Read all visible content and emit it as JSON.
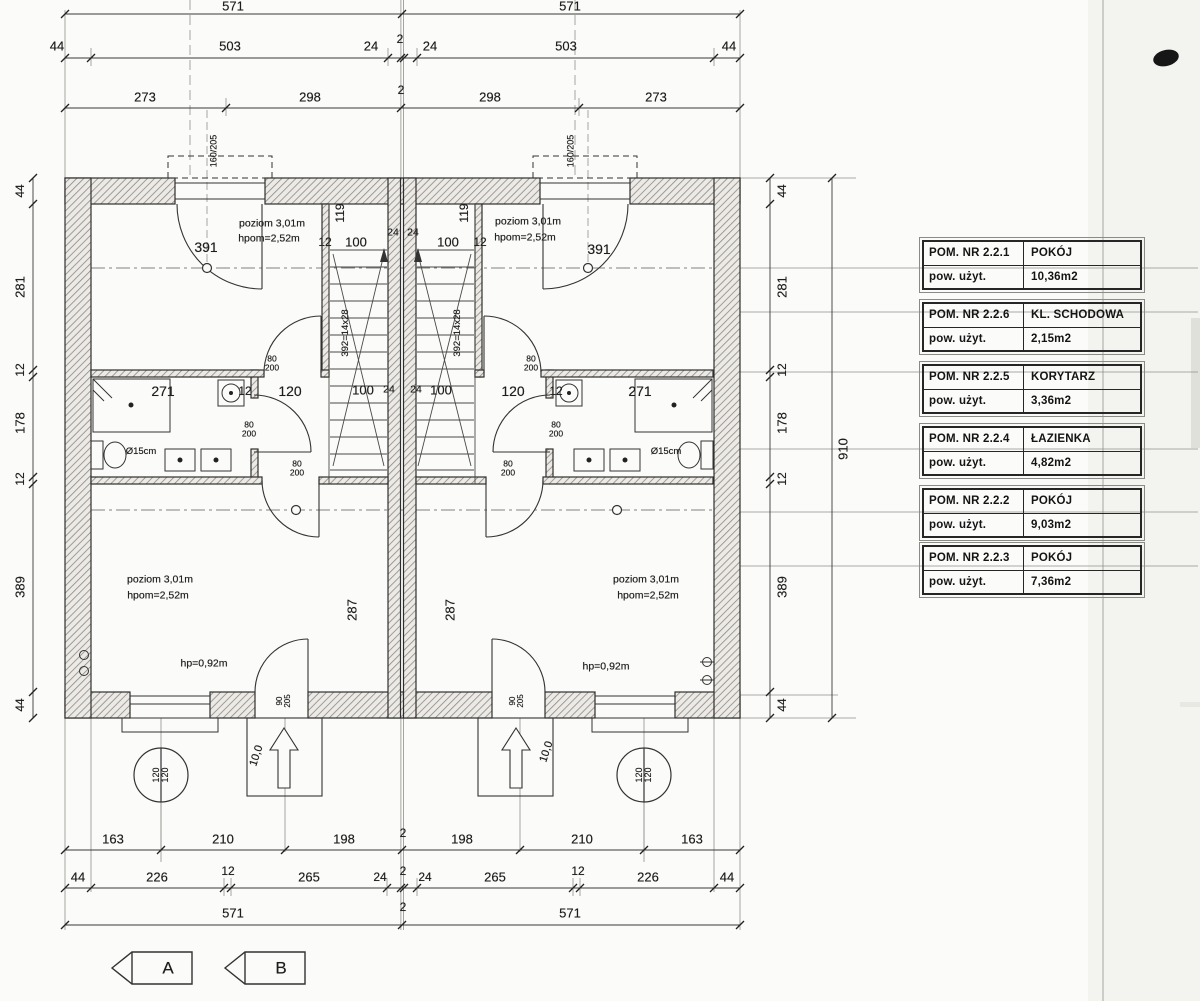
{
  "legend": {
    "rows": [
      {
        "no": "POM. NR 2.2.1",
        "name": "POKÓJ",
        "area_label": "pow. użyt.",
        "area": "10,36m2"
      },
      {
        "no": "POM. NR 2.2.6",
        "name": "KL. SCHODOWA",
        "area_label": "pow. użyt.",
        "area": "2,15m2"
      },
      {
        "no": "POM. NR 2.2.5",
        "name": "KORYTARZ",
        "area_label": "pow. użyt.",
        "area": "3,36m2"
      },
      {
        "no": "POM. NR 2.2.4",
        "name": "ŁAZIENKA",
        "area_label": "pow. użyt.",
        "area": "4,82m2"
      },
      {
        "no": "POM. NR 2.2.2",
        "name": "POKÓJ",
        "area_label": "pow. użyt.",
        "area": "9,03m2"
      },
      {
        "no": "POM. NR 2.2.3",
        "name": "POKÓJ",
        "area_label": "pow. użyt.",
        "area": "7,36m2"
      }
    ]
  },
  "annotations": [
    {
      "t": "571",
      "x": 233,
      "y": 6
    },
    {
      "t": "571",
      "x": 570,
      "y": 6
    },
    {
      "t": "44",
      "x": 57,
      "y": 46
    },
    {
      "t": "503",
      "x": 230,
      "y": 46
    },
    {
      "t": "24",
      "x": 371,
      "y": 46
    },
    {
      "t": "2",
      "x": 400,
      "y": 39,
      "s": 12
    },
    {
      "t": "24",
      "x": 430,
      "y": 46
    },
    {
      "t": "503",
      "x": 566,
      "y": 46
    },
    {
      "t": "44",
      "x": 729,
      "y": 46
    },
    {
      "t": "273",
      "x": 145,
      "y": 97
    },
    {
      "t": "298",
      "x": 310,
      "y": 97
    },
    {
      "t": "2",
      "x": 401,
      "y": 90,
      "s": 12
    },
    {
      "t": "298",
      "x": 490,
      "y": 97
    },
    {
      "t": "273",
      "x": 656,
      "y": 97
    },
    {
      "t": "44",
      "x": 20,
      "y": 191,
      "r": -90,
      "s": 12
    },
    {
      "t": "281",
      "x": 20,
      "y": 287,
      "r": -90
    },
    {
      "t": "12",
      "x": 20,
      "y": 370,
      "r": -90,
      "s": 12
    },
    {
      "t": "178",
      "x": 20,
      "y": 423,
      "r": -90
    },
    {
      "t": "12",
      "x": 20,
      "y": 479,
      "r": -90,
      "s": 12
    },
    {
      "t": "389",
      "x": 20,
      "y": 587,
      "r": -90
    },
    {
      "t": "44",
      "x": 20,
      "y": 705,
      "r": -90,
      "s": 12
    },
    {
      "t": "44",
      "x": 782,
      "y": 191,
      "r": -90,
      "s": 12
    },
    {
      "t": "281",
      "x": 782,
      "y": 287,
      "r": -90
    },
    {
      "t": "12",
      "x": 782,
      "y": 370,
      "r": -90,
      "s": 12
    },
    {
      "t": "178",
      "x": 782,
      "y": 423,
      "r": -90
    },
    {
      "t": "12",
      "x": 782,
      "y": 479,
      "r": -90,
      "s": 12
    },
    {
      "t": "389",
      "x": 782,
      "y": 587,
      "r": -90
    },
    {
      "t": "44",
      "x": 782,
      "y": 705,
      "r": -90,
      "s": 12
    },
    {
      "t": "910",
      "x": 843,
      "y": 449,
      "r": -90
    },
    {
      "t": "160/205",
      "x": 214,
      "y": 151,
      "r": -90,
      "s": 9,
      "n": "window-size-label"
    },
    {
      "t": "160/205",
      "x": 571,
      "y": 151,
      "r": -90,
      "s": 9,
      "n": "window-size-label"
    },
    {
      "t": "poziom 3,01m",
      "x": 272,
      "y": 224,
      "s": 10.5,
      "n": "room-level-label"
    },
    {
      "t": "hpom=2,52m",
      "x": 269,
      "y": 239,
      "s": 10.5,
      "n": "room-height-label"
    },
    {
      "t": "391",
      "x": 206,
      "y": 247,
      "s": 14
    },
    {
      "t": "12",
      "x": 325,
      "y": 242,
      "s": 12
    },
    {
      "t": "100",
      "x": 356,
      "y": 242
    },
    {
      "t": "119",
      "x": 340,
      "y": 213,
      "r": -90,
      "s": 12
    },
    {
      "t": "24",
      "x": 393,
      "y": 233,
      "s": 10.5
    },
    {
      "t": "24",
      "x": 413,
      "y": 233,
      "s": 10.5
    },
    {
      "t": "119",
      "x": 464,
      "y": 213,
      "r": -90,
      "s": 12
    },
    {
      "t": "100",
      "x": 448,
      "y": 242
    },
    {
      "t": "12",
      "x": 480,
      "y": 242,
      "s": 12
    },
    {
      "t": "poziom 3,01m",
      "x": 528,
      "y": 222,
      "s": 10.5,
      "n": "room-level-label"
    },
    {
      "t": "hpom=2,52m",
      "x": 525,
      "y": 238,
      "s": 10.5,
      "n": "room-height-label"
    },
    {
      "t": "391",
      "x": 599,
      "y": 249,
      "s": 14
    },
    {
      "t": "271",
      "x": 163,
      "y": 391,
      "s": 14
    },
    {
      "t": "12",
      "x": 245,
      "y": 391,
      "s": 12
    },
    {
      "t": "120",
      "x": 290,
      "y": 391,
      "s": 14
    },
    {
      "t": "80\n200",
      "x": 272,
      "y": 363,
      "s": 8.5,
      "n": "door-size-label"
    },
    {
      "t": "100",
      "x": 363,
      "y": 390
    },
    {
      "t": "24",
      "x": 389,
      "y": 390,
      "s": 10.5
    },
    {
      "t": "24",
      "x": 416,
      "y": 390,
      "s": 10.5
    },
    {
      "t": "100",
      "x": 441,
      "y": 390
    },
    {
      "t": "80\n200",
      "x": 531,
      "y": 363,
      "s": 8.5,
      "n": "door-size-label"
    },
    {
      "t": "120",
      "x": 513,
      "y": 391,
      "s": 14
    },
    {
      "t": "12",
      "x": 556,
      "y": 391,
      "s": 12
    },
    {
      "t": "271",
      "x": 640,
      "y": 391,
      "s": 14
    },
    {
      "t": "392=14x28",
      "x": 346,
      "y": 333,
      "r": -90,
      "s": 9.5,
      "n": "stair-run-label"
    },
    {
      "t": "392=14x28",
      "x": 458,
      "y": 333,
      "r": -90,
      "s": 9.5,
      "n": "stair-run-label"
    },
    {
      "t": "80\n200",
      "x": 249,
      "y": 429,
      "s": 8.5,
      "n": "door-size-label"
    },
    {
      "t": "80\n200",
      "x": 556,
      "y": 429,
      "s": 8.5,
      "n": "door-size-label"
    },
    {
      "t": "Ø15cm",
      "x": 141,
      "y": 452,
      "s": 9.5,
      "n": "vent-pipe-label"
    },
    {
      "t": "Ø15cm",
      "x": 666,
      "y": 452,
      "s": 9.5,
      "n": "vent-pipe-label"
    },
    {
      "t": "80\n200",
      "x": 297,
      "y": 468,
      "s": 8.5,
      "n": "door-size-label"
    },
    {
      "t": "80\n200",
      "x": 508,
      "y": 468,
      "s": 8.5,
      "n": "door-size-label"
    },
    {
      "t": "287",
      "x": 352,
      "y": 610,
      "r": -90
    },
    {
      "t": "287",
      "x": 450,
      "y": 610,
      "r": -90
    },
    {
      "t": "poziom 3,01m",
      "x": 160,
      "y": 580,
      "s": 10.5,
      "n": "room-level-label"
    },
    {
      "t": "hpom=2,52m",
      "x": 158,
      "y": 596,
      "s": 10.5,
      "n": "room-height-label"
    },
    {
      "t": "poziom 3,01m",
      "x": 646,
      "y": 580,
      "s": 10.5,
      "n": "room-level-label"
    },
    {
      "t": "hpom=2,52m",
      "x": 648,
      "y": 596,
      "s": 10.5,
      "n": "room-height-label"
    },
    {
      "t": "hp=0,92m",
      "x": 204,
      "y": 664,
      "s": 10.5,
      "n": "window-sill-height-label"
    },
    {
      "t": "hp=0,92m",
      "x": 606,
      "y": 667,
      "s": 10.5,
      "n": "window-sill-height-label"
    },
    {
      "t": "90\n205",
      "x": 284,
      "y": 701,
      "r": -90,
      "s": 8,
      "n": "door-size-label"
    },
    {
      "t": "90\n205",
      "x": 517,
      "y": 701,
      "r": -90,
      "s": 8,
      "n": "door-size-label"
    },
    {
      "t": "10,0",
      "x": 257,
      "y": 756,
      "r": -72,
      "s": 11,
      "n": "entry-step-label"
    },
    {
      "t": "10,0",
      "x": 547,
      "y": 752,
      "r": -72,
      "s": 11,
      "n": "entry-step-label"
    },
    {
      "t": "120\n120",
      "x": 161,
      "y": 775,
      "r": -90,
      "s": 9,
      "n": "axis-marker-label"
    },
    {
      "t": "120\n120",
      "x": 644,
      "y": 775,
      "r": -90,
      "s": 9,
      "n": "axis-marker-label"
    },
    {
      "t": "163",
      "x": 113,
      "y": 839
    },
    {
      "t": "210",
      "x": 223,
      "y": 839
    },
    {
      "t": "198",
      "x": 344,
      "y": 839
    },
    {
      "t": "2",
      "x": 403,
      "y": 833,
      "s": 12
    },
    {
      "t": "198",
      "x": 462,
      "y": 839
    },
    {
      "t": "210",
      "x": 582,
      "y": 839
    },
    {
      "t": "163",
      "x": 692,
      "y": 839
    },
    {
      "t": "44",
      "x": 78,
      "y": 877
    },
    {
      "t": "226",
      "x": 157,
      "y": 877
    },
    {
      "t": "12",
      "x": 228,
      "y": 871,
      "s": 12
    },
    {
      "t": "265",
      "x": 309,
      "y": 877
    },
    {
      "t": "24",
      "x": 380,
      "y": 877,
      "s": 12
    },
    {
      "t": "2",
      "x": 403,
      "y": 871,
      "s": 12
    },
    {
      "t": "24",
      "x": 425,
      "y": 877,
      "s": 12
    },
    {
      "t": "265",
      "x": 495,
      "y": 877
    },
    {
      "t": "12",
      "x": 578,
      "y": 871,
      "s": 12
    },
    {
      "t": "226",
      "x": 648,
      "y": 877
    },
    {
      "t": "44",
      "x": 727,
      "y": 877
    },
    {
      "t": "571",
      "x": 233,
      "y": 913
    },
    {
      "t": "2",
      "x": 403,
      "y": 907,
      "s": 12
    },
    {
      "t": "571",
      "x": 570,
      "y": 913
    },
    {
      "t": "A",
      "x": 168,
      "y": 968,
      "s": 17,
      "n": "section-marker-label"
    },
    {
      "t": "B",
      "x": 281,
      "y": 968,
      "s": 17,
      "n": "section-marker-label"
    }
  ]
}
